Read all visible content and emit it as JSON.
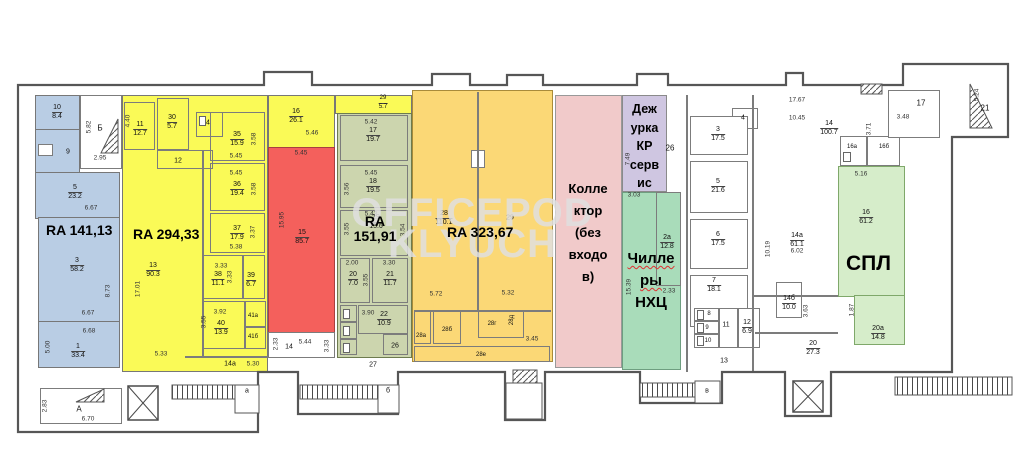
{
  "watermark": {
    "line1": "OFFICEPOD",
    "line2": "KLYUCH"
  },
  "zone_labels": {
    "blue": "RA 141,13",
    "yellow": "RA 294,33",
    "olive1": "RA",
    "olive2": "151,91",
    "orange": "RA 323,67",
    "pink": [
      "Колле",
      "ктор",
      "(без",
      "входо",
      "в)"
    ],
    "purple": [
      "Деж",
      "урка",
      "КР",
      "серв",
      "ис"
    ],
    "green": [
      "Чилле",
      "ры",
      "НХЦ"
    ],
    "spl": "СПЛ"
  },
  "colors": {
    "blue": "#b9cde4",
    "yellow": "#fafa57",
    "red": "#f4605c",
    "olive": "#ccd5ae",
    "orange": "#fbd876",
    "pink": "#f1caca",
    "purple": "#cfc6e1",
    "green": "#a9dcba",
    "spl": "#d6edca"
  },
  "rooms": {
    "b10": {
      "n": "10",
      "a": "8.4"
    },
    "b9": {
      "n": "9"
    },
    "b5": {
      "n": "5",
      "a": "23.2"
    },
    "b3": {
      "n": "3",
      "a": "58.2"
    },
    "b1": {
      "n": "1",
      "a": "33.4"
    },
    "y11": {
      "n": "11",
      "a": "12.7"
    },
    "y30": {
      "n": "30",
      "a": "5.7"
    },
    "y34": {
      "n": "34"
    },
    "y35": {
      "n": "35",
      "a": "15.9"
    },
    "y12": {
      "n": "12"
    },
    "y36": {
      "n": "36",
      "a": "19.4"
    },
    "y37": {
      "n": "37",
      "a": "17.9"
    },
    "y38": {
      "n": "38",
      "a": "11.1"
    },
    "y39": {
      "n": "39",
      "a": "6.7"
    },
    "y40": {
      "n": "40",
      "a": "13.9"
    },
    "y41a": {
      "n": "41а"
    },
    "y41b": {
      "n": "41б"
    },
    "y13": {
      "n": "13",
      "a": "90.3"
    },
    "y14a": {
      "n": "14а"
    },
    "y16": {
      "n": "16",
      "a": "26.1"
    },
    "y29": {
      "n": "29",
      "a": "5.7"
    },
    "r15": {
      "n": "15",
      "a": "85.7"
    },
    "o17": {
      "n": "17",
      "a": "19.7"
    },
    "o18": {
      "n": "18",
      "a": "19.5"
    },
    "o19": {
      "n": "19",
      "a": "15.6"
    },
    "o20": {
      "n": "20",
      "a": "7.0"
    },
    "o21": {
      "n": "21",
      "a": "11.7"
    },
    "o22": {
      "n": "22",
      "a": "10.9"
    },
    "o26": {
      "n": "26"
    },
    "c27": {
      "n": "27"
    },
    "w14": {
      "n": "14"
    },
    "g28": {
      "n": "28",
      "a": "110.1"
    },
    "g29": {
      "n": "29"
    },
    "g28a": {
      "n": "28а"
    },
    "g28b": {
      "n": "28б"
    },
    "g28g": {
      "n": "28г"
    },
    "g28d": {
      "n": "28д"
    },
    "g28e": {
      "n": "28е"
    },
    "p26": {
      "n": "26"
    },
    "ch2a": {
      "n": "2а",
      "a": "12.8"
    },
    "w3": {
      "n": "3",
      "a": "17.5"
    },
    "w4": {
      "n": "4"
    },
    "w5": {
      "n": "5",
      "a": "21.6"
    },
    "w6": {
      "n": "6",
      "a": "17.5"
    },
    "w7": {
      "n": "7",
      "a": "18.1"
    },
    "w8": {
      "n": "8"
    },
    "w9": {
      "n": "9"
    },
    "w10": {
      "n": "10"
    },
    "w11": {
      "n": "11"
    },
    "w12": {
      "n": "12",
      "a": "6.9"
    },
    "w13": {
      "n": "13"
    },
    "r14": {
      "n": "14",
      "a": "100.7"
    },
    "r16a": {
      "n": "16а"
    },
    "r16b": {
      "n": "16б"
    },
    "r17": {
      "n": "17"
    },
    "r21s": {
      "n": "21"
    },
    "r14a": {
      "n": "14а",
      "a": "61.1"
    },
    "r14b": {
      "n": "14б",
      "a": "10.0"
    },
    "r20": {
      "n": "20",
      "a": "27.3"
    },
    "s16": {
      "n": "16",
      "a": "61.2"
    },
    "s20a": {
      "n": "20а",
      "a": "14.8"
    }
  },
  "stairs": {
    "bigA": "А",
    "bigB": "Б",
    "a": "а",
    "b": "б",
    "v": "в"
  },
  "dims": {
    "b582": "5.82",
    "b295": "2.95",
    "b667a": "6.67",
    "b873": "8.73",
    "b667b": "6.67",
    "b668": "6.68",
    "b500": "5.00",
    "b670": "6.70",
    "b283": "2.83",
    "y440": "4.40",
    "y545a": "5.45",
    "y358a": "3.58",
    "y545b": "5.45",
    "y358b": "3.58",
    "y337": "3.37",
    "y538": "5.38",
    "y333a": "3.33",
    "y333b": "3.33",
    "y392": "3.92",
    "y355": "3.55",
    "y1701": "17.01",
    "y533": "5.33",
    "y530": "5.30",
    "y546": "5.46",
    "r545": "5.45",
    "r1595": "15.95",
    "w544": "5.44",
    "w233": "2.33",
    "w333": "3.33",
    "o542": "5.42",
    "o545": "5.45",
    "o356": "3.56",
    "o543": "5.43",
    "o355a": "3.55",
    "o354": "3.54",
    "o200": "2.00",
    "o355b": "3.55",
    "o330": "3.30",
    "o390": "3.90",
    "g572": "5.72",
    "g532": "5.32",
    "g345": "3.45",
    "p303": "3.03",
    "p749": "7.49",
    "c1539": "15.39",
    "c233": "2.33",
    "t1767": "17.67",
    "t1045": "10.45",
    "t371": "3.71",
    "t348": "3.48",
    "t524": "5.24",
    "t602": "6.02",
    "t1019": "10.19",
    "t363": "3.63",
    "s516": "5.16",
    "s187": "1.87"
  }
}
